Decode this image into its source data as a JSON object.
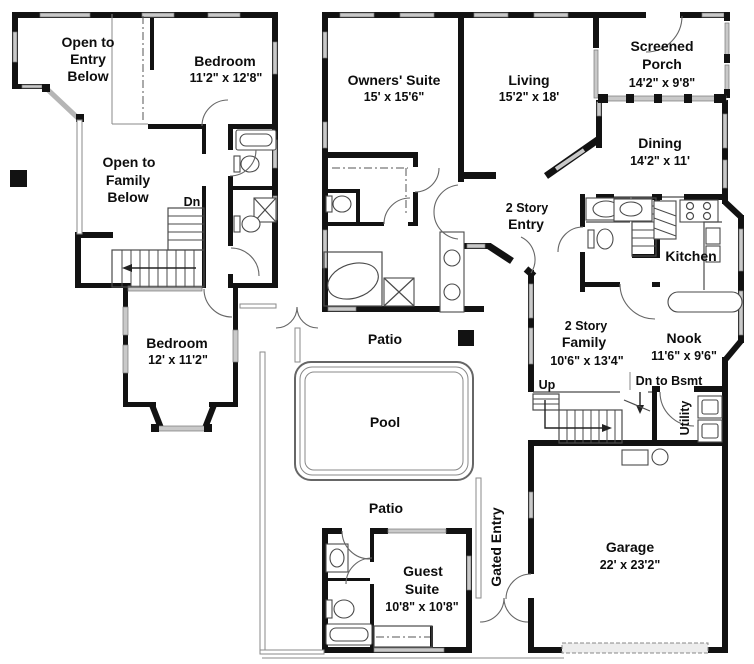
{
  "colors": {
    "wall": "#121212",
    "window": "#c9c9c9",
    "line": "#555555",
    "background": "#ffffff"
  },
  "upper_floor": {
    "open_to_entry": [
      "Open to",
      "Entry",
      "Below"
    ],
    "bedroom_upper": {
      "name": "Bedroom",
      "dims": "11'2\" x 12'8\""
    },
    "open_to_family": [
      "Open to",
      "Family",
      "Below"
    ],
    "stairs_dn": "Dn",
    "bedroom_lower": {
      "name": "Bedroom",
      "dims": "12' x 11'2\""
    }
  },
  "main_floor": {
    "owners_suite": {
      "name": "Owners' Suite",
      "dims": "15' x 15'6\""
    },
    "living": {
      "name": "Living",
      "dims": "15'2\" x 18'"
    },
    "screened_porch": {
      "lines": [
        "Screened",
        "Porch"
      ],
      "dims": "14'2\" x 9'8\""
    },
    "dining": {
      "name": "Dining",
      "dims": "14'2\" x 11'"
    },
    "entry": {
      "lines": [
        "2 Story",
        "Entry"
      ]
    },
    "kitchen": {
      "name": "Kitchen"
    },
    "family": {
      "lines": [
        "2 Story",
        "Family"
      ],
      "dims": "10'6\" x 13'4\""
    },
    "nook": {
      "name": "Nook",
      "dims": "11'6\" x 9'6\""
    },
    "stairs_up": "Up",
    "basement": "Dn to Bsmt",
    "utility": "Utility",
    "patio_upper": "Patio",
    "pool": "Pool",
    "patio_lower": "Patio",
    "guest_suite": {
      "lines": [
        "Guest",
        "Suite"
      ],
      "dims": "10'8\" x 10'8\""
    },
    "gated_entry": "Gated Entry",
    "garage": {
      "name": "Garage",
      "dims": "22' x 23'2\""
    }
  }
}
